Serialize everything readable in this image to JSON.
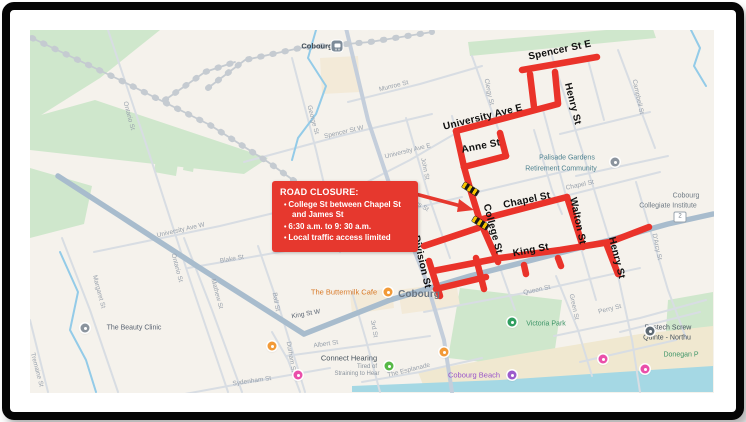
{
  "annotation": {
    "title": "ROAD CLOSURE:",
    "bullets": [
      "College St between Chapel St and James St",
      "6:30 a.m. to 9: 30 a.m.",
      "Local traffic access limited"
    ],
    "arrow": {
      "from": [
        389,
        187
      ],
      "to": [
        461,
        206
      ],
      "tip": [
        474,
        210
      ]
    },
    "box_color": "#e6382e",
    "text_color": "#ffffff"
  },
  "map": {
    "city_label": {
      "text": "Cobourg",
      "x": 419,
      "y": 295
    },
    "station": {
      "label": "Cobourg",
      "x": 317,
      "y": 46,
      "icon_x": 337,
      "icon_y": 46
    },
    "route_shield": {
      "text": "2",
      "x": 680,
      "y": 217
    },
    "closure_route": {
      "color": "#ea332a",
      "segments": [
        [
          [
            522,
            70
          ],
          [
            597,
            57
          ]
        ],
        [
          [
            530,
            74
          ],
          [
            534,
            107
          ]
        ],
        [
          [
            555,
            72
          ],
          [
            558,
            103
          ]
        ],
        [
          [
            456,
            131
          ],
          [
            558,
            104
          ]
        ],
        [
          [
            456,
            131
          ],
          [
            464,
            167
          ]
        ],
        [
          [
            464,
            167
          ],
          [
            506,
            156
          ]
        ],
        [
          [
            500,
            133
          ],
          [
            506,
            156
          ]
        ],
        [
          [
            464,
            167
          ],
          [
            471,
            192
          ],
          [
            480,
            221
          ]
        ],
        [
          [
            480,
            221
          ],
          [
            498,
            262
          ]
        ],
        [
          [
            479,
            220
          ],
          [
            567,
            197
          ]
        ],
        [
          [
            567,
            197
          ],
          [
            583,
            247
          ]
        ],
        [
          [
            433,
            271
          ],
          [
            500,
            258
          ],
          [
            560,
            250
          ],
          [
            610,
            242
          ],
          [
            649,
            227
          ]
        ],
        [
          [
            429,
            261
          ],
          [
            440,
            296
          ]
        ],
        [
          [
            424,
            246
          ],
          [
            478,
            228
          ]
        ],
        [
          [
            436,
            289
          ],
          [
            486,
            277
          ]
        ],
        [
          [
            476,
            258
          ],
          [
            484,
            289
          ]
        ],
        [
          [
            606,
            243
          ],
          [
            618,
            274
          ]
        ],
        [
          [
            524,
            265
          ],
          [
            526,
            274
          ]
        ],
        [
          [
            558,
            258
          ],
          [
            561,
            266
          ]
        ]
      ],
      "hazard_markers": [
        {
          "x": 470,
          "y": 189,
          "rot": 32
        },
        {
          "x": 480,
          "y": 223,
          "rot": 32
        }
      ]
    },
    "closure_street_labels": [
      {
        "text": "Spencer St E",
        "x": 560,
        "y": 51,
        "rot": -12
      },
      {
        "text": "Henry St",
        "x": 572,
        "y": 104,
        "rot": 76
      },
      {
        "text": "University Ave E",
        "x": 483,
        "y": 118,
        "rot": -14
      },
      {
        "text": "Anne St",
        "x": 481,
        "y": 147,
        "rot": -11
      },
      {
        "text": "Chapel St",
        "x": 527,
        "y": 201,
        "rot": -12
      },
      {
        "text": "Walton St",
        "x": 577,
        "y": 221,
        "rot": 78
      },
      {
        "text": "College St",
        "x": 492,
        "y": 229,
        "rot": 75
      },
      {
        "text": "King St",
        "x": 531,
        "y": 251,
        "rot": -11
      },
      {
        "text": "Division St",
        "x": 421,
        "y": 262,
        "rot": 77
      },
      {
        "text": "Henry St",
        "x": 616,
        "y": 258,
        "rot": 76
      }
    ],
    "street_labels": [
      {
        "text": "Ontario St",
        "x": 128,
        "y": 116,
        "rot": 75
      },
      {
        "text": "Ontario St",
        "x": 176,
        "y": 268,
        "rot": 75
      },
      {
        "text": "Margaret St",
        "x": 98,
        "y": 292,
        "rot": 75
      },
      {
        "text": "Mathew St",
        "x": 216,
        "y": 294,
        "rot": 75
      },
      {
        "text": "Blake St",
        "x": 232,
        "y": 260,
        "rot": -10
      },
      {
        "text": "Sydenham St",
        "x": 252,
        "y": 382,
        "rot": -8
      },
      {
        "text": "Tremaine St",
        "x": 36,
        "y": 370,
        "rot": 75
      },
      {
        "text": "University Ave W",
        "x": 181,
        "y": 231,
        "rot": -13
      },
      {
        "text": "University Ave E",
        "x": 408,
        "y": 152,
        "rot": -14
      },
      {
        "text": "Spencer St W",
        "x": 344,
        "y": 133,
        "rot": -13
      },
      {
        "text": "Munroe St",
        "x": 394,
        "y": 87,
        "rot": -14
      },
      {
        "text": "George St",
        "x": 312,
        "y": 120,
        "rot": 75
      },
      {
        "text": "John St",
        "x": 424,
        "y": 169,
        "rot": 78
      },
      {
        "text": "James St",
        "x": 416,
        "y": 204,
        "rot": 30
      },
      {
        "text": "Clergy St",
        "x": 488,
        "y": 92,
        "rot": 78
      },
      {
        "text": "Campbell St",
        "x": 637,
        "y": 97,
        "rot": 78
      },
      {
        "text": "D'Arcy St",
        "x": 656,
        "y": 247,
        "rot": 78
      },
      {
        "text": "Chapel St",
        "x": 580,
        "y": 186,
        "rot": -12
      },
      {
        "text": "Queen St",
        "x": 537,
        "y": 291,
        "rot": -12
      },
      {
        "text": "Green St",
        "x": 573,
        "y": 307,
        "rot": 78
      },
      {
        "text": "Perry St",
        "x": 610,
        "y": 310,
        "rot": -14
      },
      {
        "text": "Albert St",
        "x": 326,
        "y": 345,
        "rot": -8
      },
      {
        "text": "Ball St",
        "x": 275,
        "y": 302,
        "rot": 80
      },
      {
        "text": "Durham St",
        "x": 290,
        "y": 357,
        "rot": 80
      },
      {
        "text": "3rd St",
        "x": 373,
        "y": 329,
        "rot": 80
      },
      {
        "text": "The Esplanade",
        "x": 409,
        "y": 371,
        "rot": -14
      },
      {
        "text": "King St W",
        "x": 306,
        "y": 315,
        "rot": -10,
        "color": "#5a6472"
      },
      {
        "text": "Division St",
        "x": 350,
        "y": 14,
        "rot": 80
      }
    ],
    "places": [
      {
        "text": "Cobourg",
        "x": 419,
        "y": 295,
        "size": 10,
        "color": "#6b7682",
        "bold": true
      },
      {
        "text": "Cobourg",
        "x": 317,
        "y": 46,
        "size": 7.5,
        "color": "#3f4b55",
        "bold": true
      },
      {
        "text": "Palisade Gardens",
        "x": 567,
        "y": 158,
        "size": 7,
        "color": "#4e8290"
      },
      {
        "text": "Retirement Community",
        "x": 561,
        "y": 168.5,
        "size": 7,
        "color": "#4e8290"
      },
      {
        "text": "Cobourg",
        "x": 686,
        "y": 196,
        "size": 7,
        "color": "#6f7b85"
      },
      {
        "text": "Collegiate Institute",
        "x": 668,
        "y": 206,
        "size": 7,
        "color": "#6f7b85"
      },
      {
        "text": "Victoria Park",
        "x": 546,
        "y": 324,
        "size": 7,
        "color": "#3d9467"
      },
      {
        "text": "Cobourg Beach",
        "x": 474,
        "y": 375,
        "size": 7.5,
        "color": "#9a55c9"
      },
      {
        "text": "Donegan P",
        "x": 681,
        "y": 355,
        "size": 7,
        "color": "#3d9467"
      },
      {
        "text": "Postech Screw",
        "x": 668,
        "y": 328,
        "size": 7,
        "color": "#46525c"
      },
      {
        "text": "Quinte - Northu",
        "x": 667,
        "y": 338,
        "size": 7,
        "color": "#46525c"
      },
      {
        "text": "The Buttermilk Cafe",
        "x": 344,
        "y": 292,
        "size": 7.5,
        "color": "#d97a28"
      },
      {
        "text": "The Beauty Clinic",
        "x": 134,
        "y": 328,
        "size": 7,
        "color": "#5a6472"
      },
      {
        "text": "Connect Hearing",
        "x": 349,
        "y": 358,
        "size": 7.5,
        "color": "#46525c"
      },
      {
        "text": "Tired of",
        "x": 367,
        "y": 366.5,
        "size": 6,
        "color": "#8b949e"
      },
      {
        "text": "Straining to Hear",
        "x": 357,
        "y": 373.5,
        "size": 6,
        "color": "#8b949e"
      }
    ],
    "pois": [
      {
        "name": "train-station-icon",
        "x": 337,
        "y": 46,
        "kind": "station"
      },
      {
        "name": "restaurant-icon",
        "x": 388,
        "y": 292,
        "color": "#f29a38"
      },
      {
        "name": "restaurant-icon",
        "x": 272,
        "y": 346,
        "color": "#f29a38"
      },
      {
        "name": "restaurant-icon",
        "x": 444,
        "y": 352,
        "color": "#f29a38"
      },
      {
        "name": "hearing-clinic-icon",
        "x": 389,
        "y": 366,
        "color": "#57b947"
      },
      {
        "name": "park-tree-icon",
        "x": 512,
        "y": 322,
        "color": "#2f9e5f"
      },
      {
        "name": "beach-icon",
        "x": 512,
        "y": 375,
        "color": "#9c5ccc"
      },
      {
        "name": "lodging-icon",
        "x": 298,
        "y": 375,
        "color": "#ea4faa"
      },
      {
        "name": "lodging-icon",
        "x": 603,
        "y": 359,
        "color": "#ea4faa"
      },
      {
        "name": "lodging-icon",
        "x": 645,
        "y": 369,
        "color": "#ea4faa"
      },
      {
        "name": "business-icon",
        "x": 85,
        "y": 328,
        "color": "#8b949e"
      },
      {
        "name": "business-icon",
        "x": 615,
        "y": 162,
        "color": "#8b949e"
      },
      {
        "name": "business-icon",
        "x": 650,
        "y": 331,
        "color": "#5e6a74"
      }
    ],
    "colors": {
      "map_bg": "#f5f2ec",
      "park": "#cfe7cc",
      "water": "#a5d8e4",
      "stream": "#93cbe8",
      "sand": "#f0e8d0",
      "building": "#f3ead8",
      "road_main": "#a8bccd",
      "road_thin": "#d8dde3",
      "railway": "#c5cbd1",
      "closure_red": "#ea332a"
    }
  }
}
